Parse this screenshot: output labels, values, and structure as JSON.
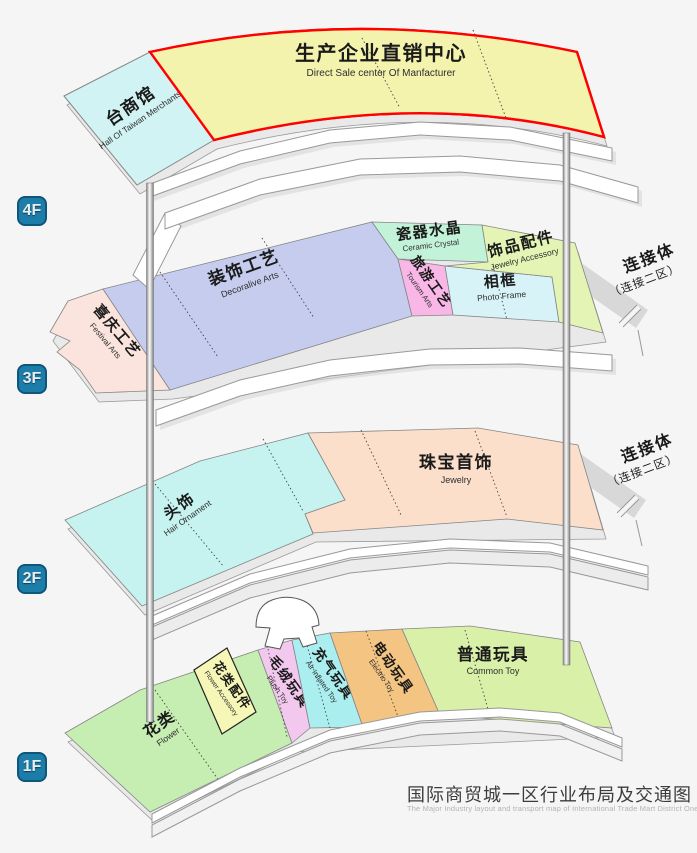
{
  "title": {
    "zh": "国际商贸城一区行业布局及交通图",
    "en": "The Major Industry layout and transport map of International Trade Mart District One"
  },
  "colors": {
    "background": "#f5f5f6",
    "floor_badge": "#1d7da9",
    "floor_badge_border": "#0f567a",
    "direct_sale_border": "#ff0000",
    "ribbon_fill": "#ffffff",
    "ribbon_stroke": "#999999",
    "slab_fill": "#e9e9e9",
    "connector_fill": "#d8d8d8"
  },
  "floors": [
    {
      "label": "4F",
      "sections": [
        {
          "id": "taiwan-hall",
          "zh": "台商馆",
          "en": "Hall Of Taiwan Merchants",
          "color": "#d2f3f3"
        },
        {
          "id": "direct-sale-center",
          "zh": "生产企业直销中心",
          "en": "Direct Sale center Of Manfacturer",
          "color": "#f3f3ae",
          "border": "#ff0000"
        }
      ]
    },
    {
      "label": "3F",
      "sections": [
        {
          "id": "festival-arts",
          "zh": "喜庆工艺",
          "en": "Festival Arts",
          "color": "#fbe4dd"
        },
        {
          "id": "decorative-arts",
          "zh": "装饰工艺",
          "en": "Decoralive Arts",
          "color": "#c6ccee"
        },
        {
          "id": "ceramic-crystal",
          "zh": "瓷器水晶",
          "en": "Ceramic Crystal",
          "color": "#c2f2d8"
        },
        {
          "id": "tourism-arts",
          "zh": "旅游工艺",
          "en": "Tourism Arts",
          "color": "#f8b7e6"
        },
        {
          "id": "photo-frame",
          "zh": "相框",
          "en": "Photo Frame",
          "color": "#d8f3f7"
        },
        {
          "id": "jewelry-accessory",
          "zh": "饰品配件",
          "en": "Jewelry Accessory",
          "color": "#e3f4b5"
        }
      ]
    },
    {
      "label": "2F",
      "sections": [
        {
          "id": "hair-ornament",
          "zh": "头饰",
          "en": "Hair Ornament",
          "color": "#c6f3ef"
        },
        {
          "id": "jewelry",
          "zh": "珠宝首饰",
          "en": "Jewelry",
          "color": "#fbdfca"
        }
      ]
    },
    {
      "label": "1F",
      "sections": [
        {
          "id": "flower",
          "zh": "花类",
          "en": "Flower",
          "color": "#c6edb2"
        },
        {
          "id": "flower-accessory",
          "zh": "花类配件",
          "en": "Flower Accessory",
          "color": "#f6f6b6"
        },
        {
          "id": "plush-toy",
          "zh": "毛绒玩具",
          "en": "Plush Toy",
          "color": "#f2c8ef"
        },
        {
          "id": "air-inflated-toy",
          "zh": "充气玩具",
          "en": "Air Inflated Toy",
          "color": "#aaeef0"
        },
        {
          "id": "electric-toy",
          "zh": "电动玩具",
          "en": "Electric Toy",
          "color": "#f3c482"
        },
        {
          "id": "common-toy",
          "zh": "普通玩具",
          "en": "Common Toy",
          "color": "#d9f0a8"
        }
      ]
    }
  ],
  "connectors": [
    {
      "id": "connector-3f",
      "line1": "连接体",
      "line2": "（连接二区）"
    },
    {
      "id": "connector-2f",
      "line1": "连接体",
      "line2": "（连接二区）"
    }
  ]
}
